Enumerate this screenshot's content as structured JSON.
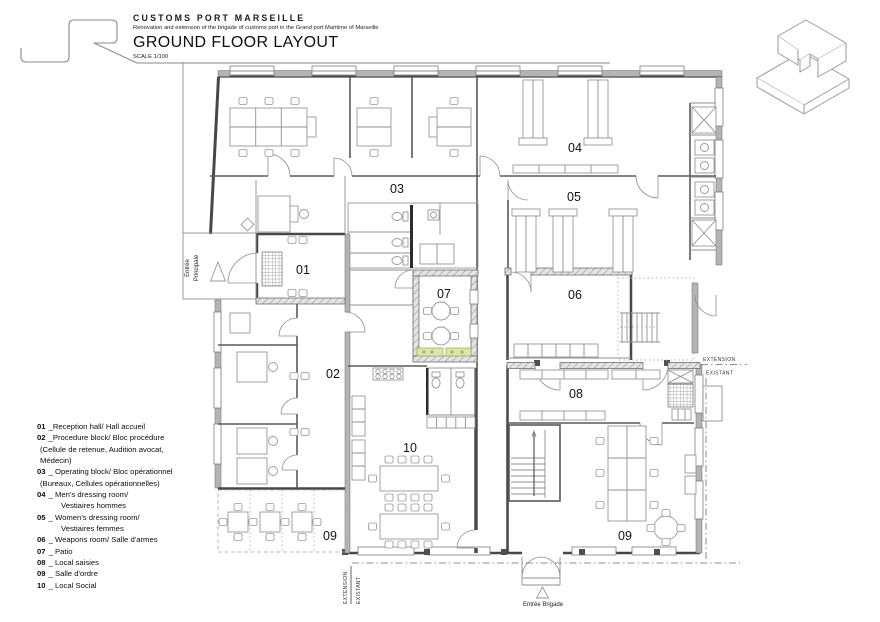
{
  "title_block": {
    "title": "CUSTOMS PORT MARSEILLE",
    "subtitle": "Renovation and extension of the brigade of customs port in the Grand port Maritime of Marseille",
    "drawing_title": "GROUND FLOOR LAYOUT",
    "scale": "SCALE 1/100"
  },
  "legend": {
    "items": [
      {
        "num": "01",
        "text": "_Reception hall/ Hall accueil",
        "indent": false
      },
      {
        "num": "02",
        "text": "_Procedure block/ Bloc procédure",
        "indent": false
      },
      {
        "num": "",
        "text": "(Cellule de retenue, Audition avocat,",
        "indent": false
      },
      {
        "num": "",
        "text": "Médecin)",
        "indent": false
      },
      {
        "num": "03",
        "text": "_ Operating block/ Bloc opérationnel",
        "indent": false
      },
      {
        "num": "",
        "text": "(Bureaux, Cellules opérationnelles)",
        "indent": false
      },
      {
        "num": "04",
        "text": "_ Men's dressing room/",
        "indent": false
      },
      {
        "num": "",
        "text": "Vestiaires hommes",
        "indent": true
      },
      {
        "num": "05",
        "text": "_ Women's dressing room/",
        "indent": false
      },
      {
        "num": "",
        "text": "Vestiaires femmes",
        "indent": true
      },
      {
        "num": "06",
        "text": "_ Weapons room/ Salle d'armes",
        "indent": false
      },
      {
        "num": "07",
        "text": "_ Patio",
        "indent": false
      },
      {
        "num": "08",
        "text": "_ Local saisies",
        "indent": false
      },
      {
        "num": "09",
        "text": "_ Salle d'ordre",
        "indent": false
      },
      {
        "num": "10",
        "text": "_ Local Social",
        "indent": false
      }
    ]
  },
  "plan": {
    "rooms": {
      "r01": "01",
      "r02": "02",
      "r03": "03",
      "r04": "04",
      "r05": "05",
      "r06": "06",
      "r07": "07",
      "r08": "08",
      "r09a": "09",
      "r09b": "09",
      "r10": "10"
    },
    "annotations": {
      "entree_principale_line1": "Entrée",
      "entree_principale_line2": "Principale",
      "entree_brigade": "Entrée Brigade",
      "extension": "EXTENSION",
      "existant": "EXISTANT"
    },
    "colors": {
      "wall": "#474747",
      "furniture": "#979797",
      "planter_green": "#d9e6ae"
    }
  }
}
